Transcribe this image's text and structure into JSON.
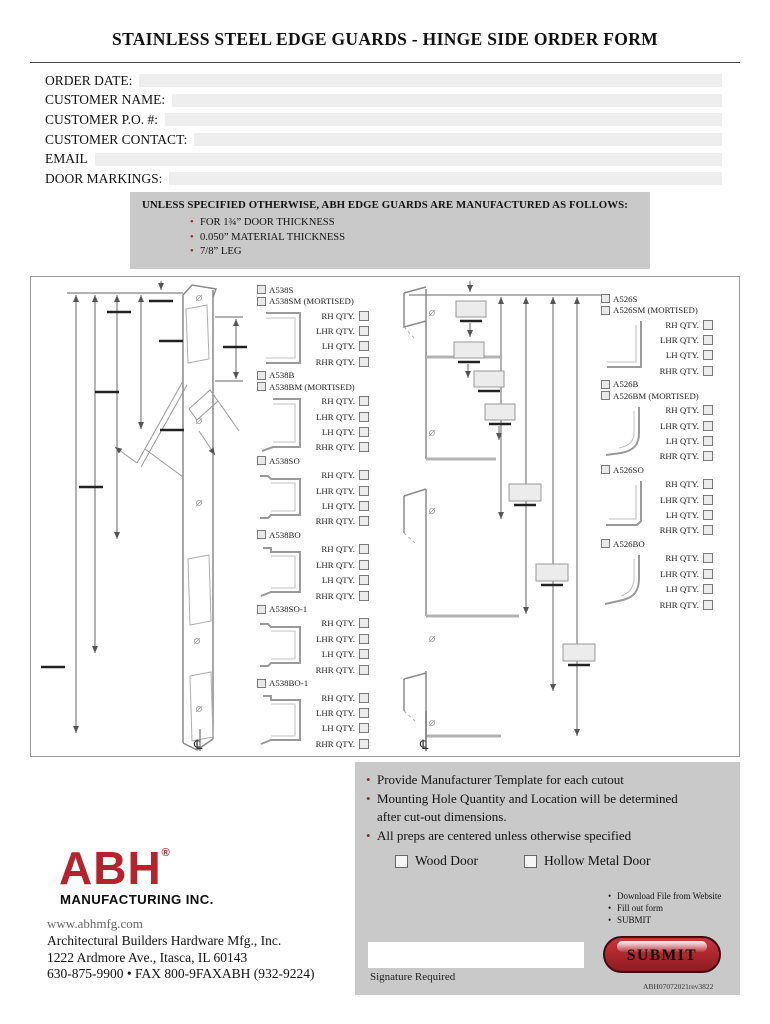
{
  "title": "STAINLESS STEEL EDGE GUARDS - HINGE SIDE ORDER FORM",
  "form_fields": [
    {
      "label": "ORDER DATE:",
      "value": ""
    },
    {
      "label": "CUSTOMER NAME:",
      "value": ""
    },
    {
      "label": "CUSTOMER P.O. #:",
      "value": ""
    },
    {
      "label": "CUSTOMER CONTACT:",
      "value": ""
    },
    {
      "label": "EMAIL",
      "value": ""
    },
    {
      "label": "DOOR MARKINGS:",
      "value": ""
    }
  ],
  "notice": {
    "heading": "UNLESS SPECIFIED OTHERWISE, ABH EDGE GUARDS ARE MANUFACTURED AS FOLLOWS:",
    "bullets": [
      "FOR 1¾” DOOR THICKNESS",
      "0.050” MATERIAL THICKNESS",
      "7/8” LEG"
    ]
  },
  "diagram": {
    "qty_labels": [
      "RH QTY.",
      "LHR QTY.",
      "LH QTY.",
      "RHR QTY."
    ],
    "left_groups": [
      {
        "models": [
          "A538S",
          "A538SM (MORTISED)"
        ],
        "profile": "c"
      },
      {
        "models": [
          "A538B",
          "A538BM (MORTISED)"
        ],
        "profile": "cb"
      },
      {
        "models": [
          "A538SO"
        ],
        "profile": "co"
      },
      {
        "models": [
          "A538BO"
        ],
        "profile": "cob"
      },
      {
        "models": [
          "A538SO-1"
        ],
        "profile": "co"
      },
      {
        "models": [
          "A538BO-1"
        ],
        "profile": "cob"
      }
    ],
    "right_groups": [
      {
        "models": [
          "A526S",
          "A526SM (MORTISED)"
        ],
        "profile": "l"
      },
      {
        "models": [
          "A526B",
          "A526BM (MORTISED)"
        ],
        "profile": "lb"
      },
      {
        "models": [
          "A526SO"
        ],
        "profile": "lo"
      },
      {
        "models": [
          "A526BO"
        ],
        "profile": "lob"
      }
    ],
    "centerline_symbol": "℄"
  },
  "footer": {
    "notes": [
      "Provide Manufacturer Template for each cutout",
      "Mounting Hole Quantity and Location will be determined after cut-out dimensions.",
      "All preps are centered unless otherwise specified"
    ],
    "door_options": [
      "Wood Door",
      "Hollow Metal Door"
    ],
    "steps": [
      "Download File from Website",
      "Fill out form",
      "SUBMIT"
    ],
    "signature_label": "Signature Required",
    "submit_label": "SUBMIT",
    "doc_number": "ABH07072021rev3822"
  },
  "company": {
    "logo": "ABH",
    "logo_mark": "®",
    "logo_sub": "MANUFACTURING INC.",
    "website": "www.abhmfg.com",
    "name": "Architectural Builders Hardware Mfg., Inc.",
    "address": "1222 Ardmore Ave., Itasca, IL 60143",
    "phone": "630-875-9900 • FAX 800-9FAXABH (932-9224)"
  },
  "colors": {
    "accent_red": "#b5232d",
    "bullet_red": "#9e2b33",
    "panel_gray": "#c9c9c9",
    "field_gray": "#eeeeee"
  }
}
